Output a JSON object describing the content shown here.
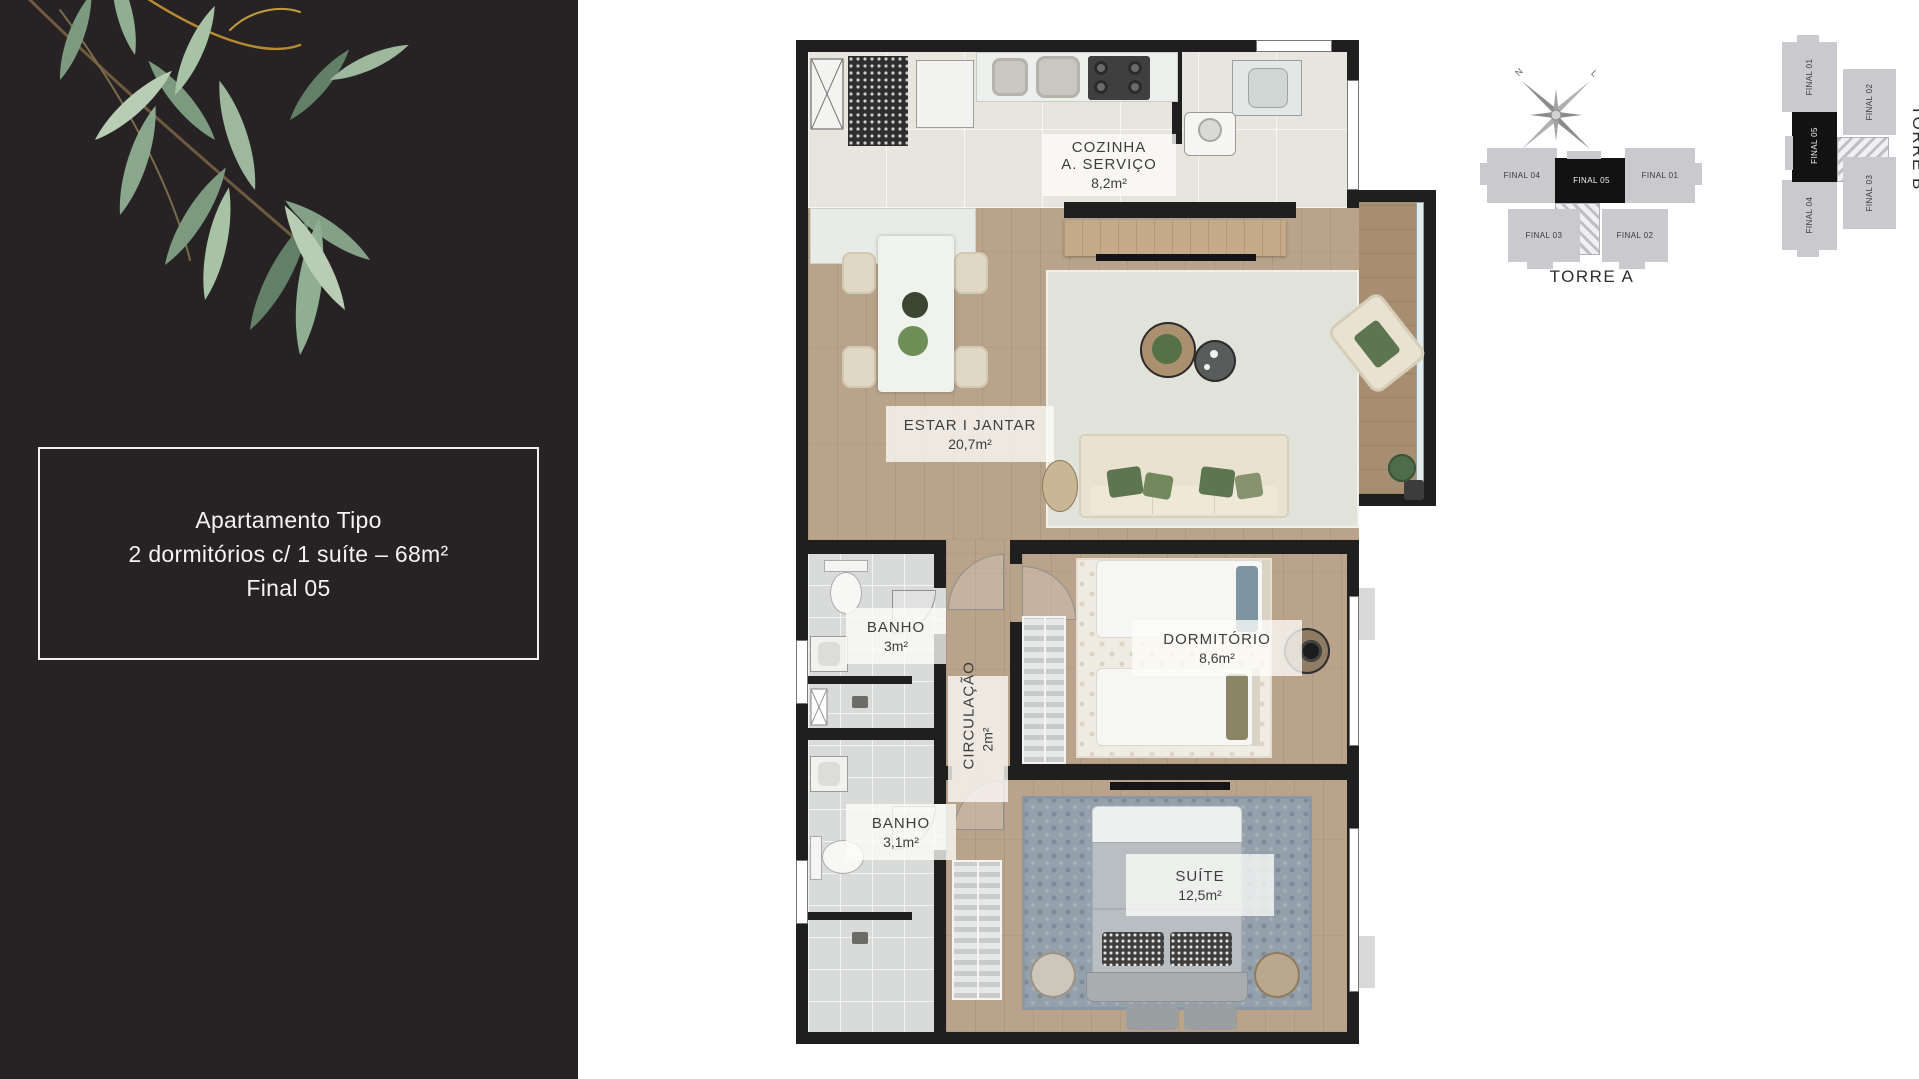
{
  "sidebar": {
    "info_box": {
      "line1": "Apartamento Tipo",
      "line2": "2 dormitórios c/ 1 suíte – 68m²",
      "line3": "Final 05"
    }
  },
  "plan": {
    "rooms": {
      "cozinha": {
        "name": "COZINHA",
        "name2": "A. SERVIÇO",
        "area": "8,2m²"
      },
      "estar": {
        "name": "ESTAR I JANTAR",
        "area": "20,7m²"
      },
      "banho1": {
        "name": "BANHO",
        "area": "3m²"
      },
      "circulacao": {
        "name": "CIRCULAÇÃO",
        "area": "2m²"
      },
      "dormitorio": {
        "name": "DORMITÓRIO",
        "area": "8,6m²"
      },
      "banho2": {
        "name": "BANHO",
        "area": "3,1m²"
      },
      "suite": {
        "name": "SUÍTE",
        "area": "12,5m²"
      }
    }
  },
  "keyplans": {
    "units": {
      "f01": "FINAL 01",
      "f02": "FINAL 02",
      "f03": "FINAL 03",
      "f04": "FINAL 04",
      "f05": "FINAL 05"
    },
    "highlighted_unit": "FINAL 05",
    "torre_a_label": "TORRE A",
    "torre_b_label": "TORRE B",
    "compass": {
      "n": "N",
      "l": "L",
      "s": "S",
      "o": "O"
    }
  },
  "colors": {
    "sidebar_bg": "#272223",
    "wall_black": "#1f1f1f",
    "wood_floor": "#b9a38b",
    "tile_floor": "#e7e5de",
    "bath_tile": "#d9dbda",
    "rug_living": "#e1e2d9",
    "rug_suite": "#94a0ab",
    "sofa_cream": "#e9e2d0",
    "pillow_green": "#5e7551",
    "keyplan_gray": "#cacace",
    "keyplan_highlight": "#121212"
  }
}
